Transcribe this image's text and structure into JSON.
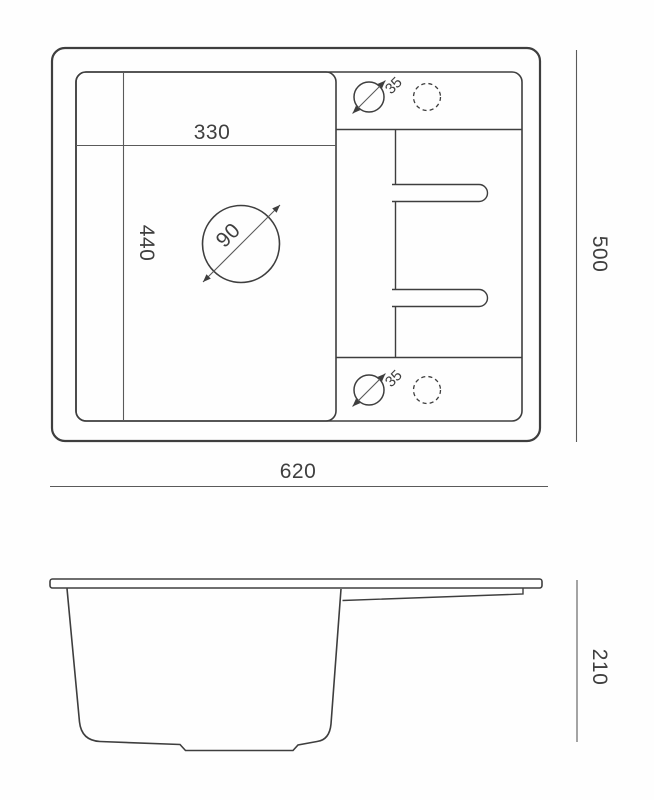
{
  "drawing": {
    "view_count": 2,
    "colors": {
      "line": "#3e3e3e",
      "dimension_line": "#5a5a5a",
      "text": "#3f3f3f",
      "background": "#fefefe"
    },
    "top_view": {
      "overall_width": "620",
      "overall_depth": "500",
      "bowl_width": "330",
      "bowl_depth": "440",
      "drain_diameter": "90",
      "tap_hole_diameter_top": "35",
      "tap_hole_diameter_bottom": "35"
    },
    "side_view": {
      "height": "210"
    }
  }
}
